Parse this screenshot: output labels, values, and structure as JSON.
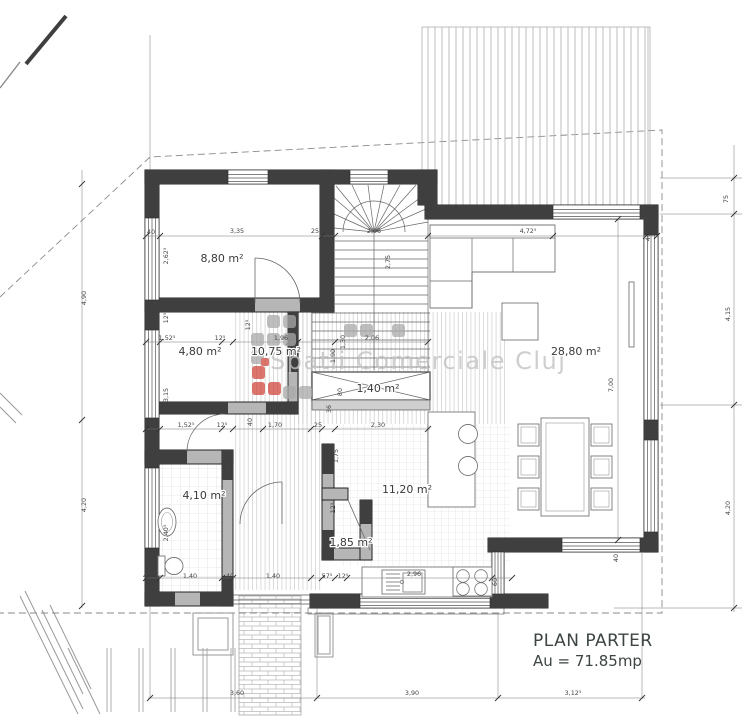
{
  "drawing": {
    "title": "PLAN PARTER",
    "area_total": "Au = 71.85mp",
    "watermark": "Spatii Comerciale Cluj",
    "rooms": [
      {
        "name": "bedroom",
        "area_label": "8,80 m²"
      },
      {
        "name": "room-2",
        "area_label": "4,80 m²"
      },
      {
        "name": "hallway",
        "area_label": "10,75 m²"
      },
      {
        "name": "stair-closet",
        "area_label": "1,40 m²"
      },
      {
        "name": "bathroom",
        "area_label": "4,10 m²"
      },
      {
        "name": "kitchen",
        "area_label": "11,20 m²"
      },
      {
        "name": "living-room",
        "area_label": "28,80 m²"
      },
      {
        "name": "pantry",
        "area_label": "1,85 m²"
      }
    ],
    "dimension_labels": [
      "40",
      "3,35",
      "25",
      "2,06",
      "4,72⁵",
      "40",
      "2,62⁵",
      "2,75",
      "4,90",
      "12⁵",
      "1,52⁵",
      "12⁵",
      "1,96",
      "1,30",
      "1,90",
      "2,06",
      "12⁵",
      "3,15",
      "80",
      "36",
      "1,52⁵",
      "12⁵",
      "40",
      "1,70",
      "25",
      "2,30",
      "1,75",
      "12⁵",
      "12⁵",
      "2,40⁵",
      "2,07⁵",
      "4,20",
      "75",
      "4,15",
      "4,20",
      "7,00",
      "40",
      "1,40",
      "40",
      "1,40",
      "57⁵",
      "12⁵",
      "2,96",
      "60",
      "40",
      "3,60",
      "3,90",
      "3,12⁵"
    ],
    "colors": {
      "wall_dark": "#3f3f3f",
      "wall_gray": "#b6b6b6",
      "dim_text": "#444444",
      "label_text": "#3a3a3a",
      "watermark_gray": "#c2c2c2",
      "logo_red": "#d0473d",
      "logo_gray": "#a9a9a9",
      "title_text": "#3c4540"
    }
  }
}
